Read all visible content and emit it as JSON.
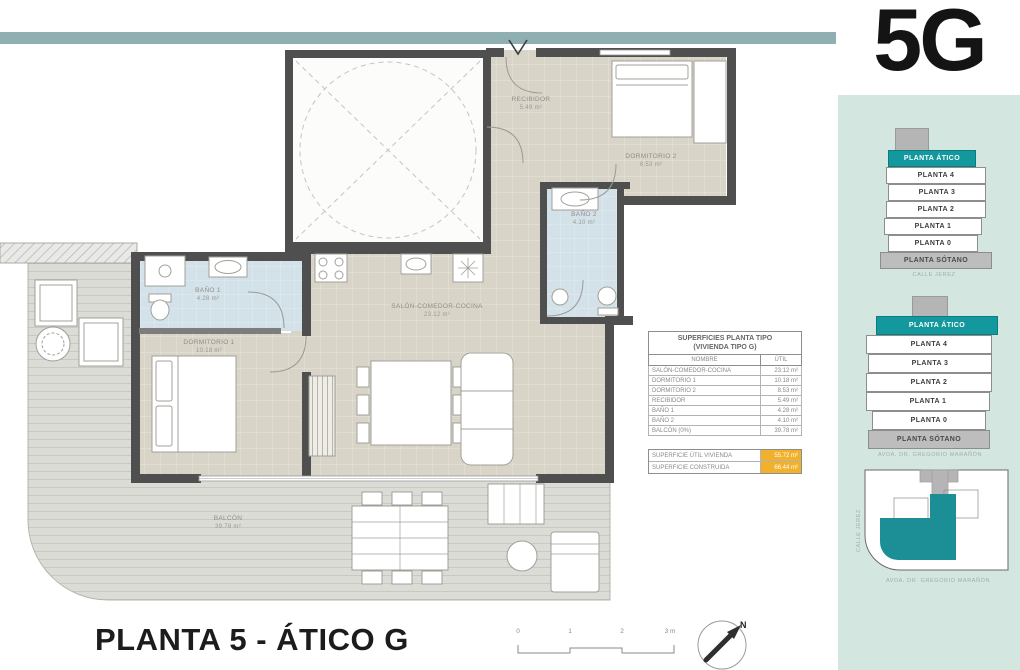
{
  "page": {
    "unit_label": "5G"
  },
  "plan": {
    "rooms": [
      {
        "name": "RECIBIDOR",
        "area": "5.49 m²"
      },
      {
        "name": "DORMITORIO 2",
        "area": "8.53 m²"
      },
      {
        "name": "BAÑO 2",
        "area": "4.10 m²"
      },
      {
        "name": "BAÑO 1",
        "area": "4.28 m²"
      },
      {
        "name": "DORMITORIO 1",
        "area": "10.18 m²"
      },
      {
        "name": "SALÓN-COMEDOR-COCINA",
        "area": "23.12 m²"
      },
      {
        "name": "BALCÓN",
        "area": "39.78 m²"
      }
    ]
  },
  "surfaces_table": {
    "title_line1": "SUPERFICIES PLANTA TIPO",
    "title_line2": "(VIVIENDA TIPO G)",
    "col_name": "NOMBRE",
    "col_util": "ÚTIL",
    "rows": [
      {
        "name": "SALÓN-COMEDOR-COCINA",
        "util": "23.12 m²"
      },
      {
        "name": "DORMITORIO 1",
        "util": "10.18 m²"
      },
      {
        "name": "DORMITORIO 2",
        "util": "8.53 m²"
      },
      {
        "name": "RECIBIDOR",
        "util": "5.49 m²"
      },
      {
        "name": "BAÑO 1",
        "util": "4.28 m²"
      },
      {
        "name": "BAÑO 2",
        "util": "4.10 m²"
      },
      {
        "name": "BALCÓN (0%)",
        "util": "39.78 m²"
      }
    ],
    "totals": [
      {
        "name": "SUPERFICIE ÚTIL VIVIENDA",
        "value": "55.72 m²"
      },
      {
        "name": "SUPERFICIE CONSTRUIDA",
        "value": "66.44 m²"
      }
    ]
  },
  "sidebar": {
    "stack_front": {
      "levels": [
        "PLANTA ÁTICO",
        "PLANTA 4",
        "PLANTA 3",
        "PLANTA 2",
        "PLANTA 1",
        "PLANTA 0",
        "PLANTA SÓTANO"
      ],
      "caption": "CALLE JEREZ"
    },
    "stack_back": {
      "levels": [
        "PLANTA ÁTICO",
        "PLANTA 4",
        "PLANTA 3",
        "PLANTA 2",
        "PLANTA 1",
        "PLANTA 0",
        "PLANTA SÓTANO"
      ],
      "caption": "AVDA. DR. GREGORIO MARAÑÓN"
    },
    "site_plan": {
      "street_left": "CALLE JEREZ",
      "street_bottom": "AVDA. DR. GREGORIO MARAÑÓN"
    }
  },
  "footer": {
    "title": "PLANTA 5 - ÁTICO G",
    "scale_ticks": [
      "0",
      "1",
      "2",
      "3 m"
    ],
    "compass_label": "N"
  },
  "colors": {
    "accent_teal": "#13989d",
    "bar_teal": "#8fafb2",
    "panel_mint": "#d4e6e0",
    "highlight_orange": "#f2b12c",
    "bath_blue": "#d3e1e9",
    "floor_beige": "#d8d4c7",
    "wall_dark": "#4f4f4f"
  }
}
